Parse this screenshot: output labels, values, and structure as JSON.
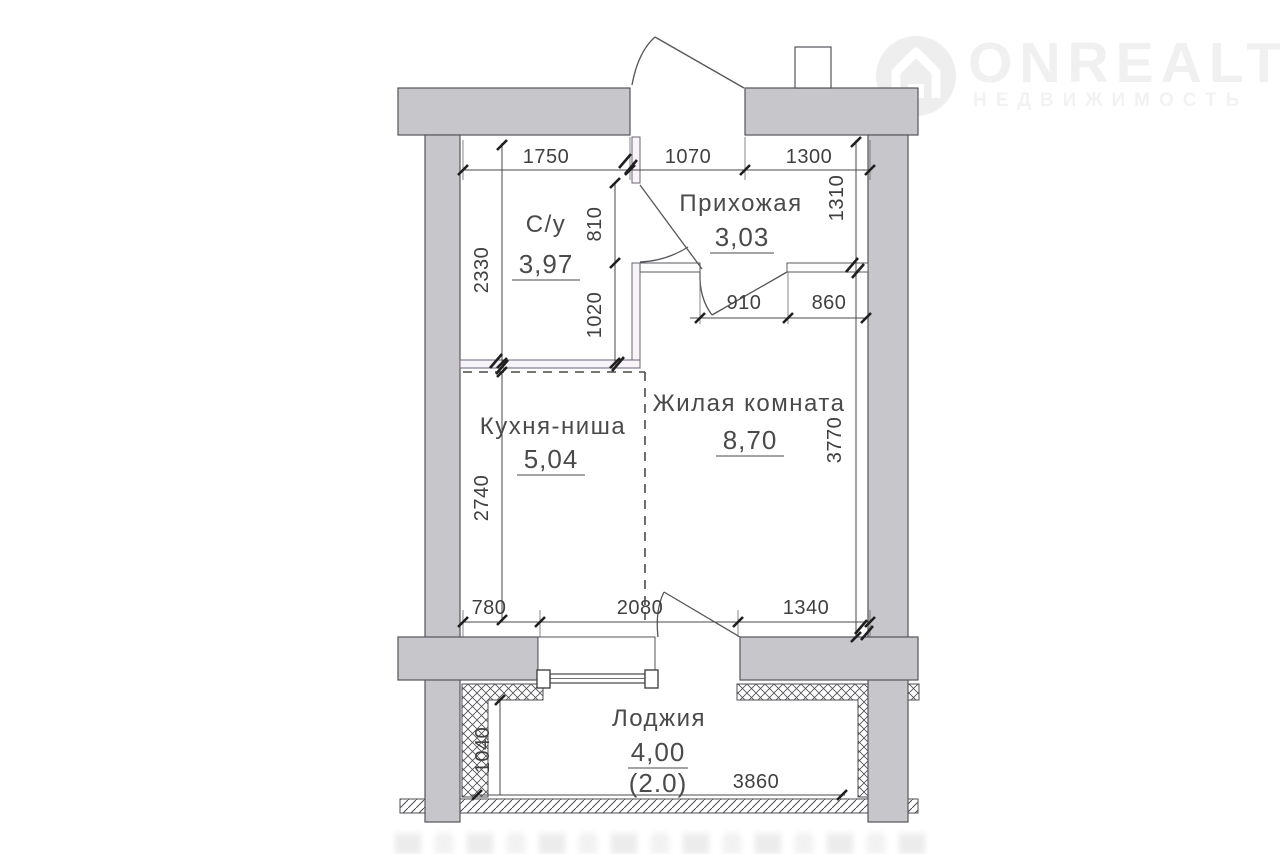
{
  "logo": {
    "brand": "ONREALT",
    "tagline": "НЕДВИЖИМОСТЬ"
  },
  "rooms": {
    "bathroom": {
      "name": "С/у",
      "area": "3,97"
    },
    "hallway": {
      "name": "Прихожая",
      "area": "3,03"
    },
    "kitchen": {
      "name": "Кухня-ниша",
      "area": "5,04"
    },
    "living": {
      "name": "Жилая комната",
      "area": "8,70"
    },
    "loggia": {
      "name": "Лоджия",
      "area": "4,00",
      "area_coeff": "(2.0)"
    }
  },
  "dims": {
    "top_left": "1750",
    "top_mid": "1070",
    "top_right": "1300",
    "bath_height": "2330",
    "bath_door": "810",
    "bath_wall": "1020",
    "hall_right": "1310",
    "hall_door": "910",
    "hall_wall": "860",
    "kitchen_left": "2740",
    "living_right": "3770",
    "bottom_left": "780",
    "bottom_mid": "2080",
    "bottom_right": "1340",
    "loggia_left": "1040",
    "loggia_width": "3860"
  },
  "colors": {
    "wall_fill": "#c7c7cb",
    "wall_edge": "#55555a",
    "line": "#3f3f3f",
    "watermark": "#f0f0f1"
  }
}
